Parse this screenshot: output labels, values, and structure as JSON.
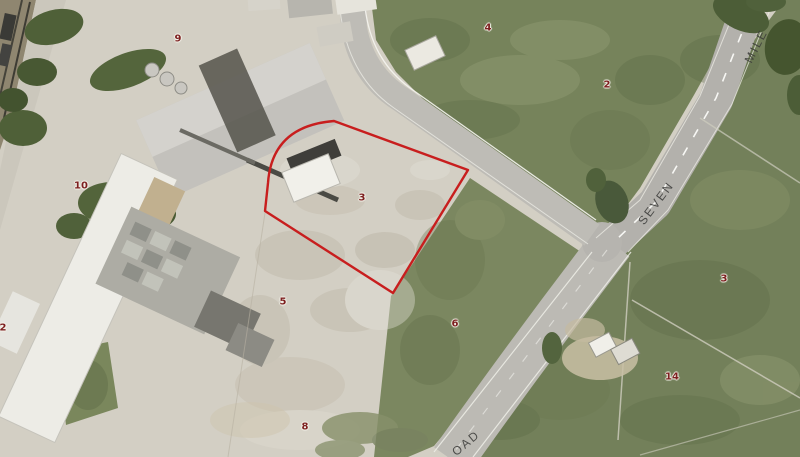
{
  "map": {
    "road_labels": {
      "mile": "MILE",
      "seven": "SEVEN",
      "road_partial": "OAD"
    },
    "parcel_numbers": {
      "p9": "9",
      "p4": "4",
      "p2_top": "2",
      "p10": "10",
      "p3_selected": "3",
      "p5": "5",
      "p6": "6",
      "p3_east": "3",
      "p14": "14",
      "p2_left": "2",
      "p8": "8"
    },
    "colors": {
      "parcel_highlight": "#c81e1e",
      "parcel_number_text": "#7d2020",
      "road_label_text": "#3a3a38"
    }
  }
}
